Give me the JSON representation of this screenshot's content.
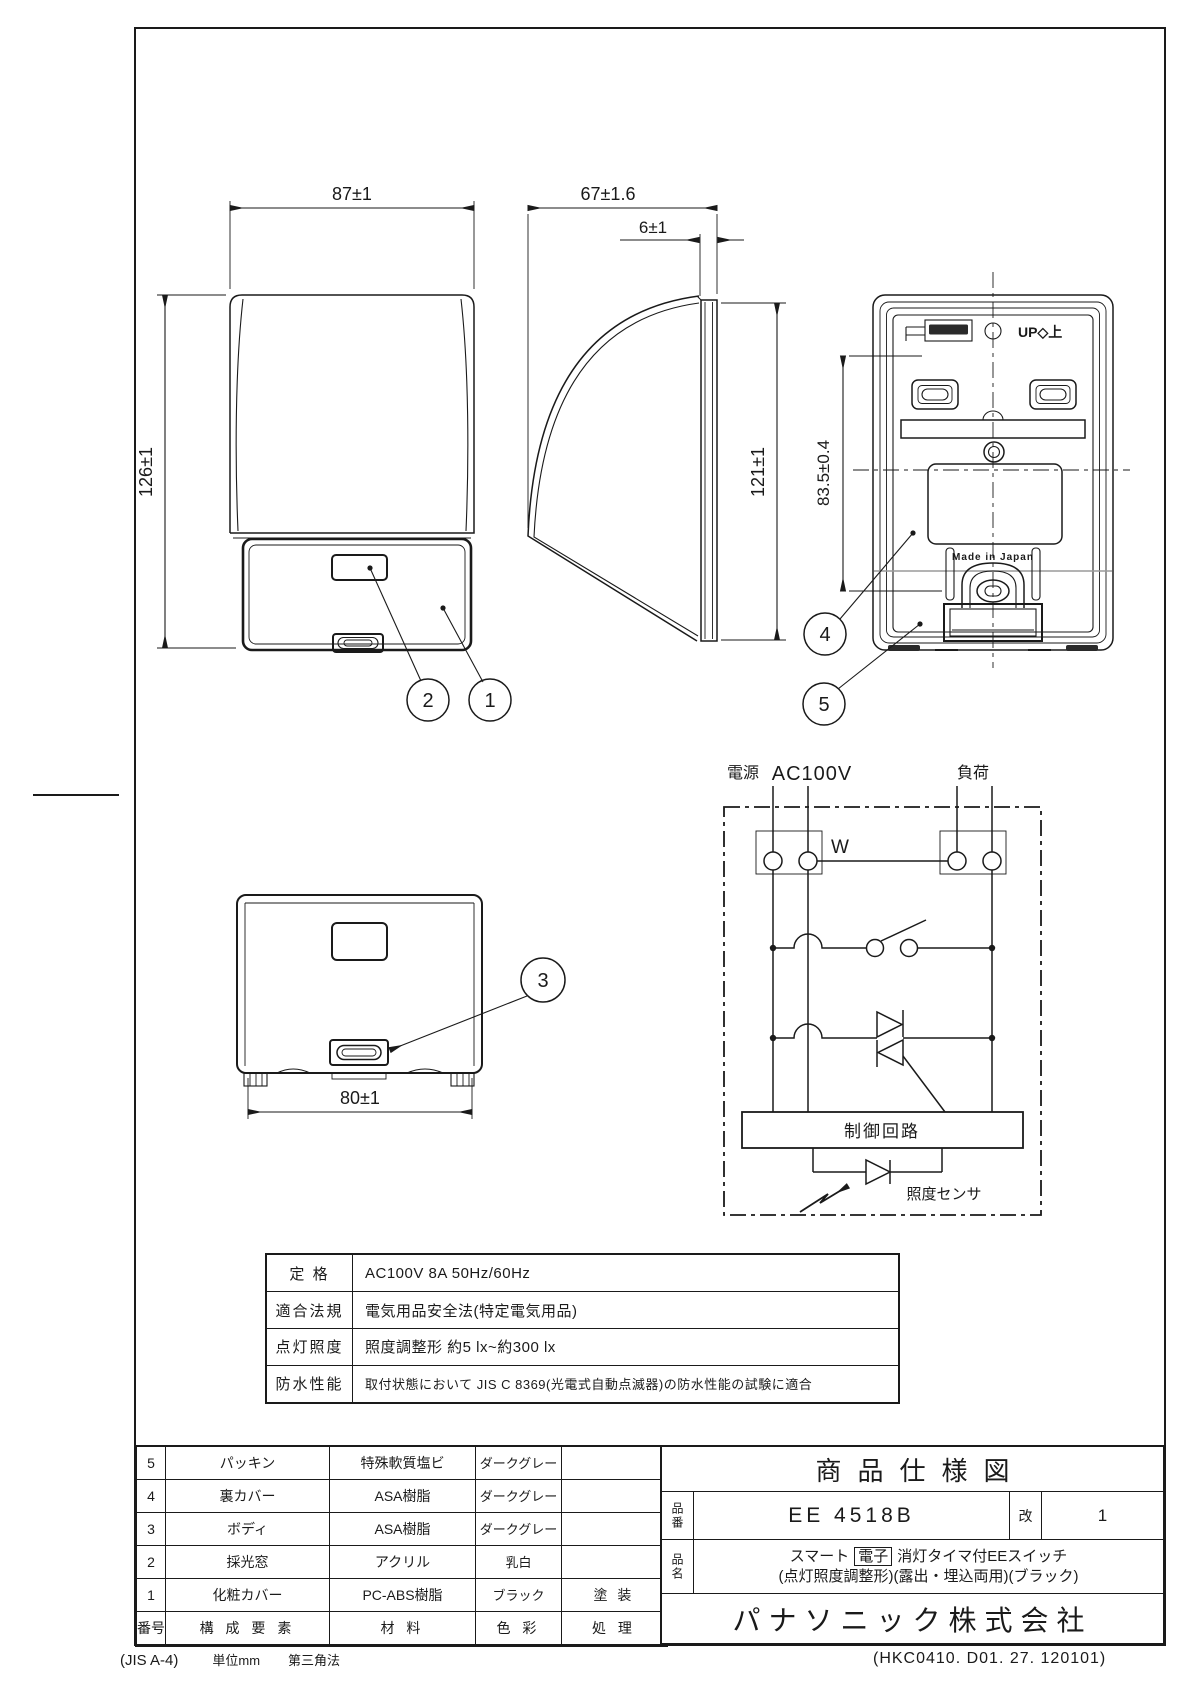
{
  "drawing": {
    "dims": {
      "front_width": "87±1",
      "front_height": "126±1",
      "side_depth": "67±1.6",
      "side_back_plate": "6±1",
      "side_height": "121±1",
      "back_mount_pitch": "83.5±0.4",
      "bottom_width": "80±1"
    },
    "callouts": {
      "c1": "1",
      "c2": "2",
      "c3": "3",
      "c4": "4",
      "c5": "5"
    },
    "back_view": {
      "up_label": "UP◇上",
      "made_in": "Made in Japan"
    }
  },
  "circuit": {
    "source_label": "電源",
    "source_voltage": "AC100V",
    "load_label": "負荷",
    "wire_label": "W",
    "control_box": "制御回路",
    "sensor_label": "照度センサ"
  },
  "spec_table": {
    "rows": [
      {
        "label": "定 格",
        "value": "AC100V 8A 50Hz/60Hz"
      },
      {
        "label": "適合法規",
        "value": "電気用品安全法(特定電気用品)"
      },
      {
        "label": "点灯照度",
        "value": "照度調整形 約5 lx~約300 lx"
      },
      {
        "label": "防水性能",
        "value": "取付状態において JIS C 8369(光電式自動点滅器)の防水性能の試験に適合"
      }
    ]
  },
  "parts_table": {
    "header": {
      "no": "番号",
      "component": "構 成 要 素",
      "material": "材  料",
      "color": "色 彩",
      "process": "処  理"
    },
    "rows": [
      {
        "no": "5",
        "component": "パッキン",
        "material": "特殊軟質塩ビ",
        "color": "ダークグレー",
        "process": ""
      },
      {
        "no": "4",
        "component": "裏カバー",
        "material": "ASA樹脂",
        "color": "ダークグレー",
        "process": ""
      },
      {
        "no": "3",
        "component": "ボディ",
        "material": "ASA樹脂",
        "color": "ダークグレー",
        "process": ""
      },
      {
        "no": "2",
        "component": "採光窓",
        "material": "アクリル",
        "color": "乳白",
        "process": ""
      },
      {
        "no": "1",
        "component": "化粧カバー",
        "material": "PC-ABS樹脂",
        "color": "ブラック",
        "process": "塗 装"
      }
    ]
  },
  "title_block": {
    "doc_title": "商品仕様図",
    "part_no_label": "品番",
    "part_no": "EE 4518B",
    "rev_label": "改",
    "rev_value": "1",
    "product_name_label": "品名",
    "product_name_1a": "スマート",
    "product_name_badge": "電子",
    "product_name_1b": "消灯タイマ付EEスイッチ",
    "product_name_2": "(点灯照度調整形)(露出・埋込両用)(ブラック)",
    "company": "パナソニック株式会社"
  },
  "footer": {
    "sheet": "(JIS A-4)",
    "unit": "単位mm",
    "projection": "第三角法",
    "doc_code": "(HKC0410. D01. 27. 120101)"
  }
}
